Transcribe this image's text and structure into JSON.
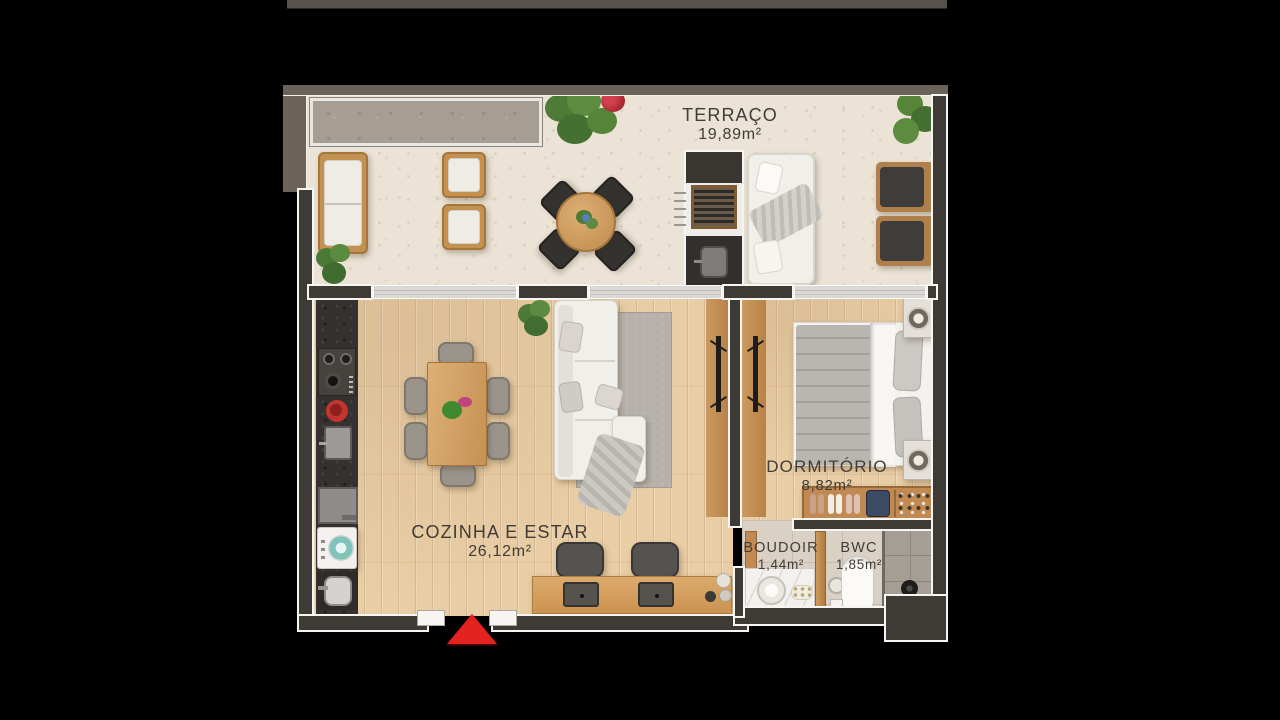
{
  "plan": {
    "type": "apartment-floorplan",
    "rooms": [
      {
        "id": "terraco",
        "name": "TERRAÇO",
        "area": "19,89m²"
      },
      {
        "id": "cozinha-estar",
        "name": "COZINHA E ESTAR",
        "area": "26,12m²"
      },
      {
        "id": "dormitorio",
        "name": "DORMITÓRIO",
        "area": "8,82m²"
      },
      {
        "id": "boudoir",
        "name": "BOUDOIR",
        "area": "1,44m²"
      },
      {
        "id": "bwc",
        "name": "BWC",
        "area": "1,85m²"
      }
    ],
    "icons": {
      "entrance": "red-triangle-up-arrow"
    },
    "colors": {
      "background": "#000000",
      "wall_interior": "#3e3a35",
      "wall_exterior": "#6b6259",
      "wall_outline": "#f7f5f2",
      "floor_terrace_stone": "#ebe3d5",
      "floor_wood": "#e9cda4",
      "floor_tile": "#d8d1c4",
      "label_text": "#403c37",
      "entrance_marker": "#e2231f"
    }
  }
}
